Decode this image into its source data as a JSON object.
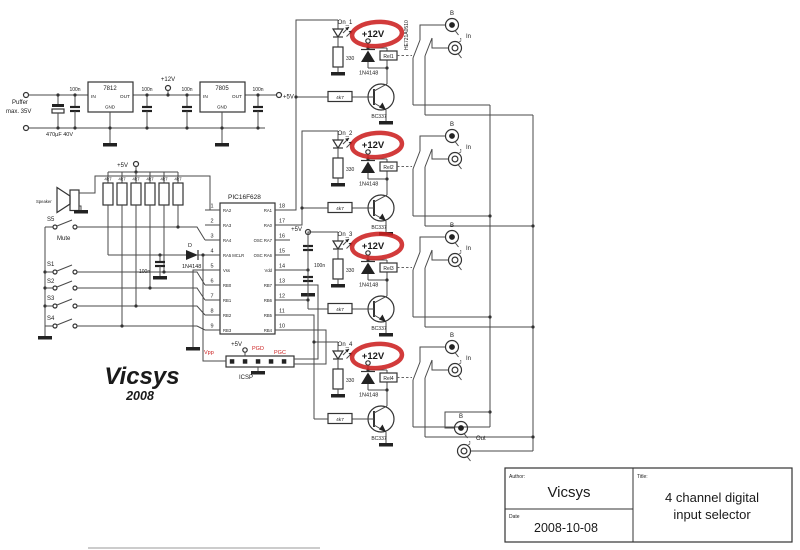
{
  "colors": {
    "wire": "#4a4a4a",
    "component": "#333333",
    "red_highlight": "#cc2020",
    "text": "#1a1a1a"
  },
  "psu": {
    "puffer1": "Puffer",
    "puffer2": "max. 35V",
    "bigcap": "470µF 40V",
    "cap": "100n",
    "reg1": "7812",
    "reg2": "7805",
    "in": "IN",
    "out": "OUT",
    "gnd": "GND",
    "v12": "+12V",
    "v5": "+5V"
  },
  "pullups": {
    "value": "4k7",
    "rail": "+5V"
  },
  "speaker": {
    "label": "Speaker"
  },
  "switches": {
    "s5": "S5",
    "mute": "Mute",
    "s1": "S1",
    "s2": "S2",
    "s3": "S3",
    "s4": "S4"
  },
  "mclr": {
    "d": "D",
    "diode": "1N4148",
    "cap": "100n"
  },
  "mcu": {
    "name": "PIC16F628",
    "left": [
      {
        "n": "1",
        "l": "RA2"
      },
      {
        "n": "2",
        "l": "RA3"
      },
      {
        "n": "3",
        "l": "RA4"
      },
      {
        "n": "4",
        "l": "RA5 MCLR"
      },
      {
        "n": "5",
        "l": "Vss"
      },
      {
        "n": "6",
        "l": "RB0"
      },
      {
        "n": "7",
        "l": "RB1"
      },
      {
        "n": "8",
        "l": "RB2"
      },
      {
        "n": "9",
        "l": "RB3"
      }
    ],
    "right": [
      {
        "n": "18",
        "l": "RA1"
      },
      {
        "n": "17",
        "l": "RA0"
      },
      {
        "n": "16",
        "l": "OSC  RA7"
      },
      {
        "n": "15",
        "l": "OSC  RA6"
      },
      {
        "n": "14",
        "l": "Vdd"
      },
      {
        "n": "13",
        "l": "RB7"
      },
      {
        "n": "12",
        "l": "RB6"
      },
      {
        "n": "11",
        "l": "RB5"
      },
      {
        "n": "10",
        "l": "RB4"
      }
    ]
  },
  "decoupling": {
    "v5": "+5V",
    "cap": "100n"
  },
  "icsp": {
    "vpp": "Vpp",
    "v5": "+5V",
    "pgd": "PGD",
    "pgc": "PGC",
    "label": "ICSP"
  },
  "channels": [
    {
      "led": "On_1",
      "r1": "330",
      "rail": "+12V",
      "diode": "1N4148",
      "relay": "Rel1",
      "part": "HE721A0510",
      "q": "BC337",
      "r2": "4k7"
    },
    {
      "led": "On_2",
      "r1": "330",
      "rail": "+12V",
      "diode": "1N4148",
      "relay": "Rel2",
      "part": "",
      "q": "BC337",
      "r2": "4k7"
    },
    {
      "led": "On_3",
      "r1": "330",
      "rail": "+12V",
      "diode": "1N4148",
      "relay": "Rel3",
      "part": "",
      "q": "BC337",
      "r2": "4k7"
    },
    {
      "led": "On_4",
      "r1": "330",
      "rail": "+12V",
      "diode": "1N4148",
      "relay": "Rel4",
      "part": "",
      "q": "BC337",
      "r2": "4k7"
    }
  ],
  "connectors": {
    "pairs": [
      {
        "b": "B",
        "j": "J",
        "label": "In"
      },
      {
        "b": "B",
        "j": "J",
        "label": "In"
      },
      {
        "b": "B",
        "j": "J",
        "label": "In"
      },
      {
        "b": "B",
        "j": "J",
        "label": "In"
      },
      {
        "b": "B",
        "j": "J",
        "label": "Out"
      }
    ]
  },
  "logo": {
    "name": "Vicsys",
    "year": "2008"
  },
  "titleblock": {
    "author_label": "Author:",
    "author": "Vicsys",
    "date_label": "Date",
    "date": "2008-10-08",
    "title_label": "Title:",
    "title1": "4 channel digital",
    "title2": "input selector"
  }
}
